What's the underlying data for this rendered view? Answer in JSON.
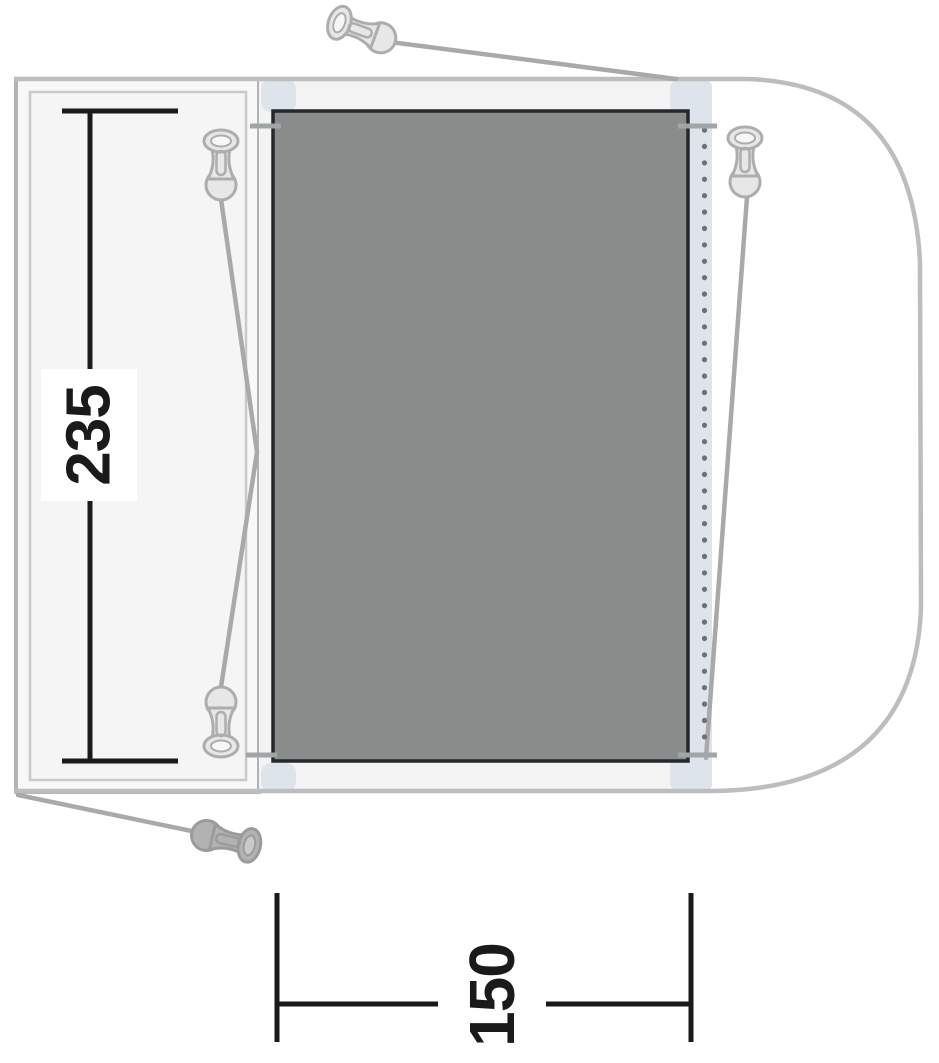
{
  "diagram": {
    "kind": "drive-away-awning-floorplan",
    "dimension_labels": {
      "depth": "235",
      "width": "150"
    },
    "colors": {
      "groundsheet_fill": "#888d8b",
      "groundsheet_border": "#24272b",
      "vehicle_outline": "#bdbdbd",
      "annex_outline": "#b3b3b3",
      "guy_line": "#a9a9a9",
      "dimension_line": "#1a1a1a",
      "connector_strip": "#dee4ec",
      "beading_dots": "#717171",
      "peg_fill": "#e7e7e7",
      "peg_outline": "#adadad"
    },
    "icons": [
      {
        "name": "tent-peg-icon",
        "count": 5
      }
    ]
  }
}
